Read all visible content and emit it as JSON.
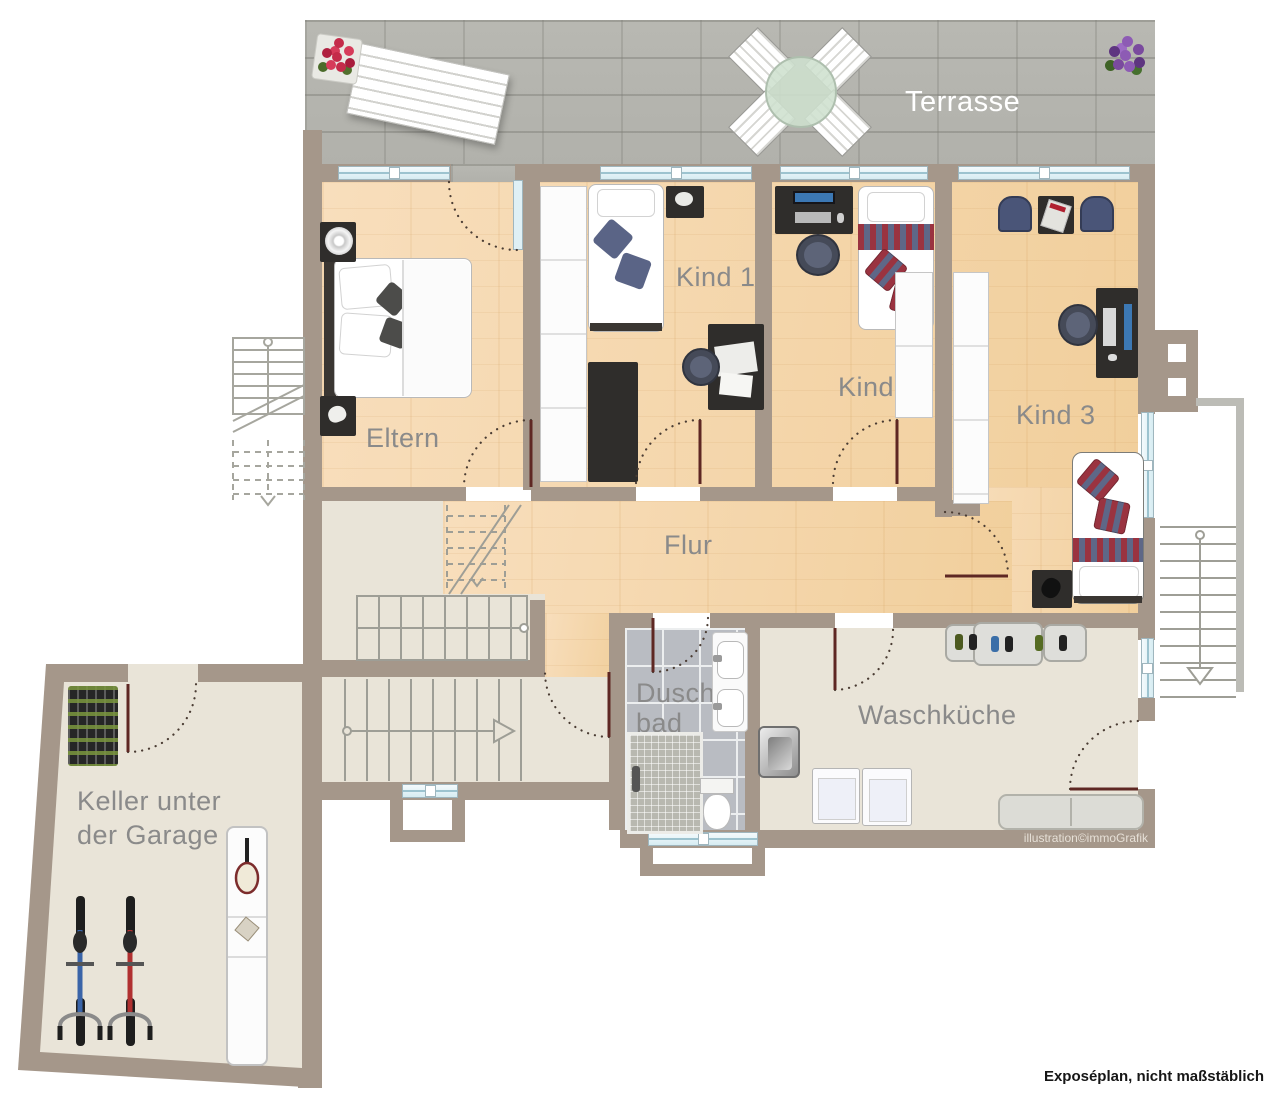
{
  "rooms": {
    "terrasse": "Terrasse",
    "eltern": "Eltern",
    "kind1": "Kind 1",
    "kind2": "Kind 2",
    "kind3": "Kind 3",
    "flur": "Flur",
    "duschbad1": "Dusch-",
    "duschbad2": "bad",
    "waschkueche": "Waschküche",
    "keller1": "Keller unter",
    "keller2": "der Garage"
  },
  "notes": {
    "watermark": "illustration©immoGrafik",
    "footer": "Exposéplan, nicht maßstäblich"
  },
  "colors": {
    "wall": "#a5978a",
    "wood_floor": "#f3d6a6",
    "stone_floor": "#e9e4d8",
    "tile_floor": "#b9bcc2",
    "terrace_paving": "#b5b5af",
    "label_grey": "#8a8a8a",
    "label_white": "#ffffff",
    "door_leaf": "#5e2723"
  }
}
